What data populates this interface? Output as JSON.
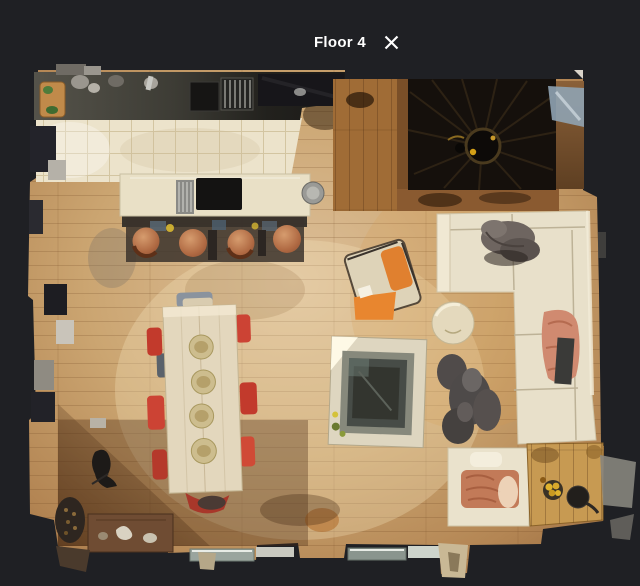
{
  "header": {
    "title": "Floor 4",
    "close_icon": "close-x"
  },
  "theme": {
    "background": "#1f2024",
    "title_color": "#ffffff",
    "wood_floor": "#c9a170",
    "wood_shadow": "#8a5c33",
    "kitchen_tile": "#ece3cb",
    "counter_dark": "#26251f",
    "island_cream": "#e9e0c6",
    "sofa_cream": "#e8e0ca",
    "stair_dark": "#15100c",
    "orange_armchair": "#e0802f",
    "red_dining_chair": "#c43a2c",
    "copper_stool": "#b5714c",
    "salmon_blanket": "#d08a70",
    "fur_throw_gray": "#6b615c"
  },
  "scene": {
    "objects": [
      "kitchen-counter",
      "kitchen-island",
      "bar-stools",
      "spiral-staircase",
      "dining-table",
      "dining-chairs",
      "sectional-sofa",
      "fur-throw",
      "salmon-blanket",
      "orange-armchair",
      "pouf",
      "fire-table",
      "sheepskin-rug",
      "bench-daybed",
      "wood-mat",
      "storage-chest",
      "basket",
      "sculpture",
      "window-ledges"
    ]
  }
}
